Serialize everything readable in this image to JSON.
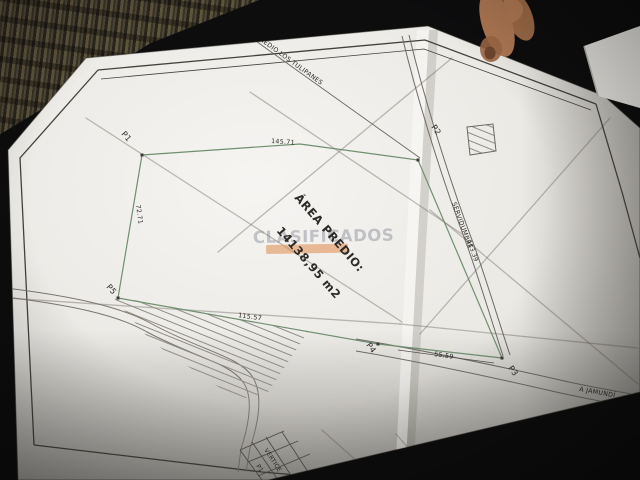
{
  "photo": {
    "background_color": "#0d0d0e",
    "paper_color": "#eae8e3"
  },
  "plan": {
    "neighbor_label": "PREDIO LOS TULIPANES",
    "area_label": {
      "line1": "ÁREA PREDIO:",
      "line2": "14138,95 m2"
    },
    "easement": {
      "name": "SERVIDUMBRE",
      "length": "113.39"
    },
    "road_destination": "A JAMUNDÍ",
    "vertices": {
      "p1": "P1",
      "p2": "P2",
      "p3": "P3",
      "p4": "P4",
      "p5": "P5"
    },
    "measurements": {
      "top_edge": "145.71",
      "left_edge": "72.71",
      "bottom_left_edge": "115.57",
      "bottom_right_edge": "55.59"
    },
    "title_block": {
      "header": "VERTICE",
      "first_row": "P1"
    },
    "outline_color": "#6f8f6f"
  },
  "watermark": {
    "text": "CLASIFICADOS",
    "bar_color": "#e08a4d"
  }
}
